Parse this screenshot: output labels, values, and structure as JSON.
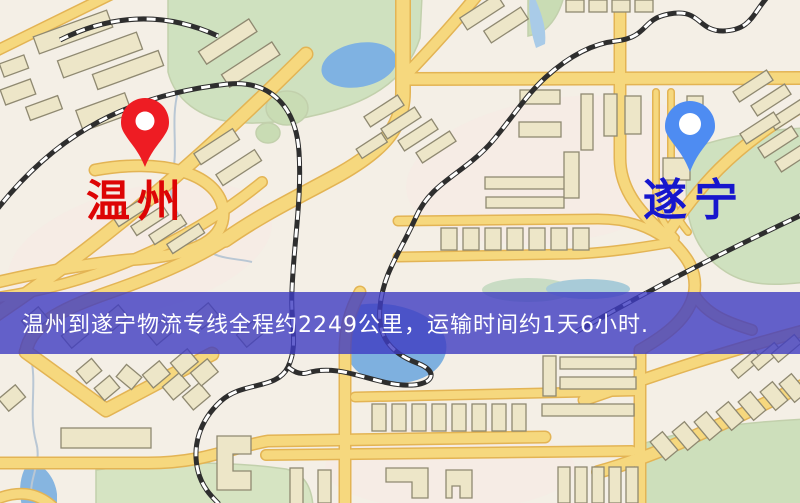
{
  "markers": {
    "origin": {
      "label": "温州",
      "label_color": "#dd0505",
      "pin_color": "#ee1c23"
    },
    "destination": {
      "label": "遂宁",
      "label_color": "#1616cd",
      "pin_color": "#4e8cf2"
    }
  },
  "banner": {
    "text": "温州到遂宁物流专线全程约2249公里，运输时间约1天6小时.",
    "background": "rgba(62,60,194,0.8)",
    "text_color": "#ffffff"
  },
  "route": {
    "origin": "温州",
    "destination": "遂宁",
    "distance_text": "约2249公里",
    "duration_text": "约1天6小时"
  },
  "map_colors": {
    "background": "#f4efe6",
    "road_fill": "#f6d87e",
    "road_casing": "#e3b454",
    "green_area": "#cfe1bf",
    "water": "#7fb2e2",
    "building": "#ede6c8",
    "railway_dark": "#2e2e2e"
  }
}
